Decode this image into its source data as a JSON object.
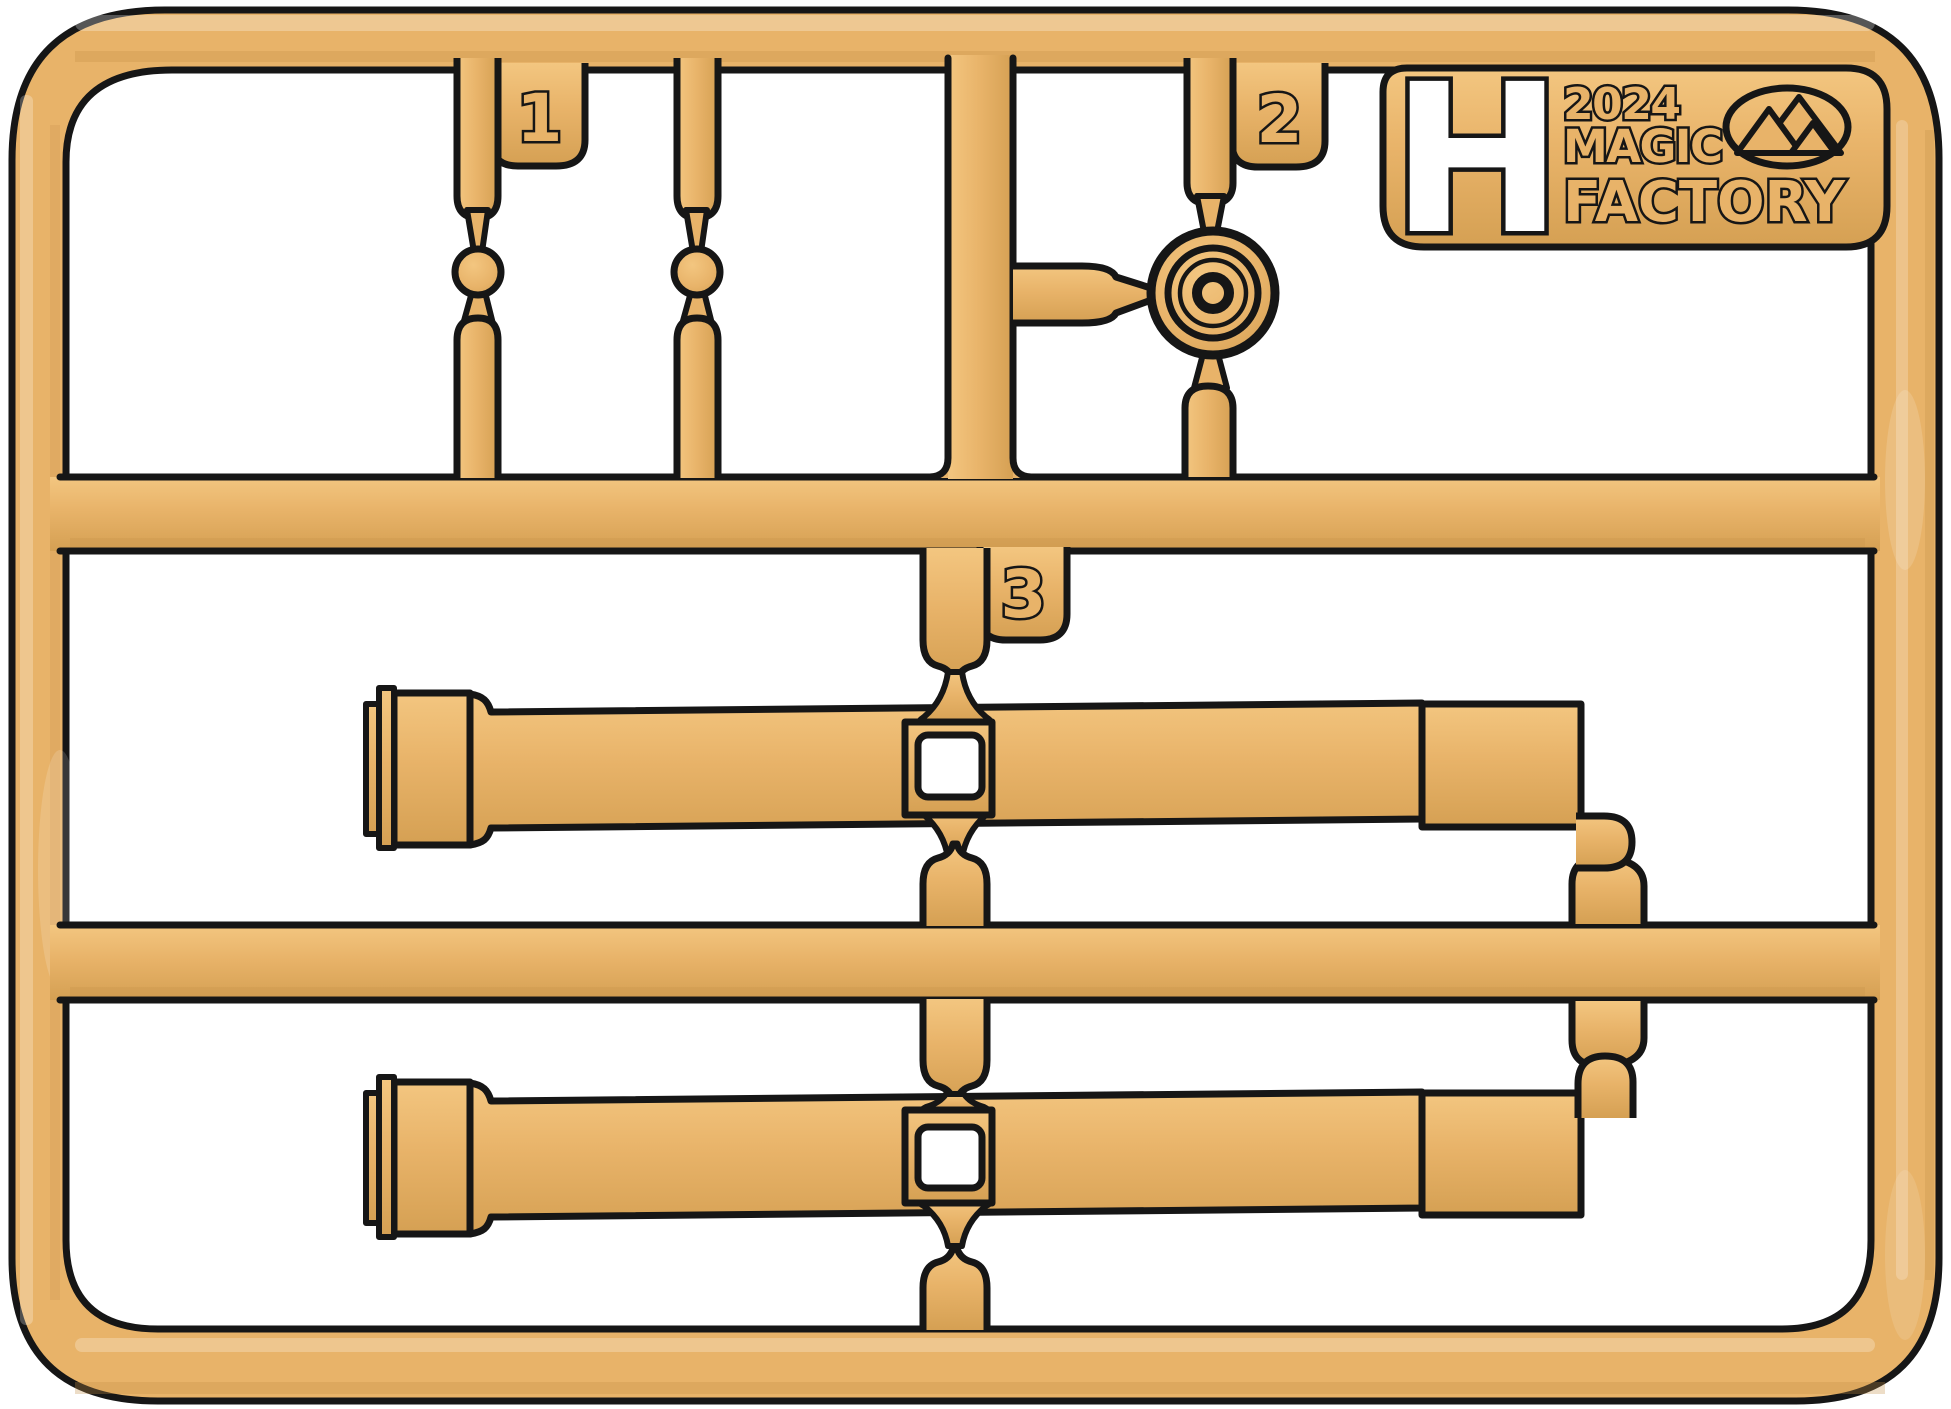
{
  "colors": {
    "background": "#FFFFFF",
    "tan": "#E8B369",
    "tanLight": "#F3C680",
    "tanDark": "#D5A053",
    "tanDeep": "#C38F47",
    "ink": "#161616",
    "hole": "#FFFFFF"
  },
  "labels": {
    "part1": "1",
    "part2": "2",
    "part3": "3"
  },
  "logo": {
    "sprue_letter": "H",
    "year": "2024",
    "brand_line1": "MAGIC",
    "brand_line2": "FACTORY",
    "badge_icon": "mountain-logo"
  }
}
